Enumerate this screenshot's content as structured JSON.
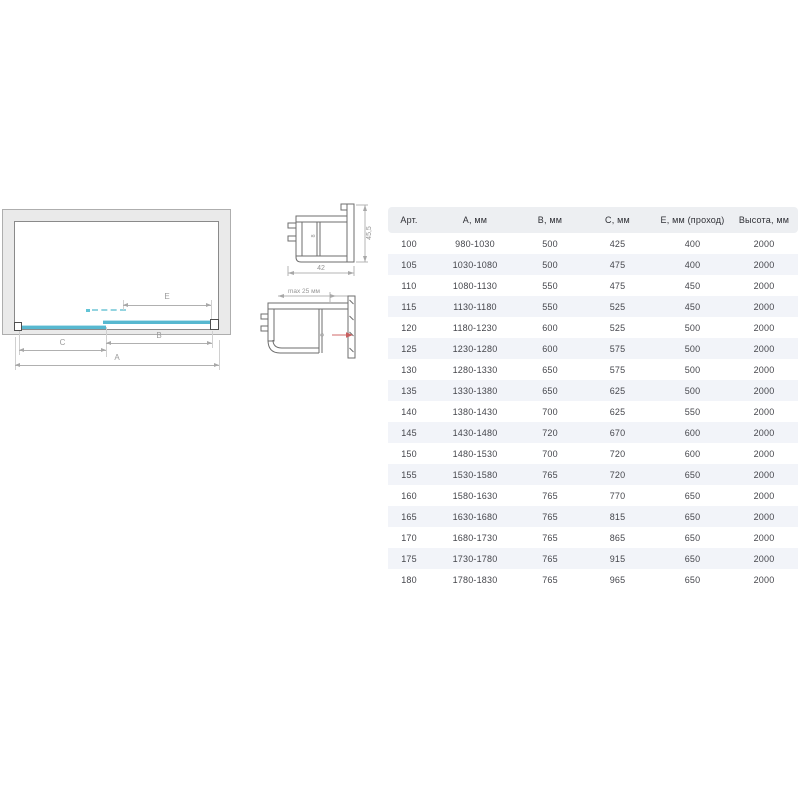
{
  "diagram": {
    "dim_labels": {
      "e": "E",
      "b": "B",
      "c": "C",
      "a": "A"
    }
  },
  "profiles": {
    "top": {
      "width": "42",
      "height": "45,5",
      "glass": "8"
    },
    "bottom": {
      "max_adjust": "max 25 мм",
      "glass": "8"
    }
  },
  "table": {
    "headers": [
      "Арт.",
      "А, мм",
      "В, мм",
      "С, мм",
      "Е, мм (проход)",
      "Высота, мм"
    ],
    "rows": [
      [
        "100",
        "980-1030",
        "500",
        "425",
        "400",
        "2000"
      ],
      [
        "105",
        "1030-1080",
        "500",
        "475",
        "400",
        "2000"
      ],
      [
        "110",
        "1080-1130",
        "550",
        "475",
        "450",
        "2000"
      ],
      [
        "115",
        "1130-1180",
        "550",
        "525",
        "450",
        "2000"
      ],
      [
        "120",
        "1180-1230",
        "600",
        "525",
        "500",
        "2000"
      ],
      [
        "125",
        "1230-1280",
        "600",
        "575",
        "500",
        "2000"
      ],
      [
        "130",
        "1280-1330",
        "650",
        "575",
        "500",
        "2000"
      ],
      [
        "135",
        "1330-1380",
        "650",
        "625",
        "500",
        "2000"
      ],
      [
        "140",
        "1380-1430",
        "700",
        "625",
        "550",
        "2000"
      ],
      [
        "145",
        "1430-1480",
        "720",
        "670",
        "600",
        "2000"
      ],
      [
        "150",
        "1480-1530",
        "700",
        "720",
        "600",
        "2000"
      ],
      [
        "155",
        "1530-1580",
        "765",
        "720",
        "650",
        "2000"
      ],
      [
        "160",
        "1580-1630",
        "765",
        "770",
        "650",
        "2000"
      ],
      [
        "165",
        "1630-1680",
        "765",
        "815",
        "650",
        "2000"
      ],
      [
        "170",
        "1680-1730",
        "765",
        "865",
        "650",
        "2000"
      ],
      [
        "175",
        "1730-1780",
        "765",
        "915",
        "650",
        "2000"
      ],
      [
        "180",
        "1780-1830",
        "765",
        "965",
        "650",
        "2000"
      ]
    ]
  },
  "colors": {
    "glass_blue": "#57b8d0",
    "wall_gray": "#eaeaea",
    "adjust_arrow_red": "#c75f5f",
    "table_header_bg": "#edeff2",
    "table_stripe_bg": "#f2f4f9"
  }
}
